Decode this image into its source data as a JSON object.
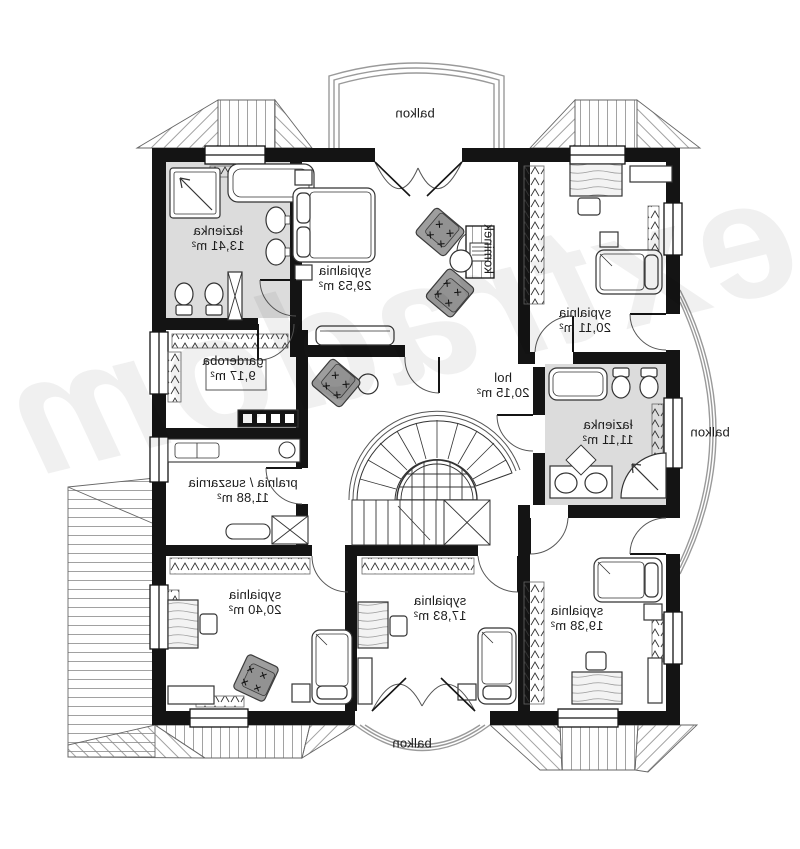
{
  "watermark": "extradom",
  "colors": {
    "wall": "#141414",
    "bath_floor": "#dcdcdc",
    "armchair": "#9e9e9e"
  },
  "labels": {
    "balcony": "balkon",
    "fireplace": "kominek"
  },
  "rooms": {
    "bath1": {
      "name": "łazienka",
      "area": "13,41 m²"
    },
    "master": {
      "name": "sypialnia",
      "area": "29,53 m²"
    },
    "bed2": {
      "name": "sypialnia",
      "area": "20,11 m²"
    },
    "wardrobe": {
      "name": "garderoba",
      "area": "9,17 m²"
    },
    "hall": {
      "name": "hol",
      "area": "20,15 m²"
    },
    "bath2": {
      "name": "łazienka",
      "area": "11,11 m²"
    },
    "laundry": {
      "name": "pralnia / suszarnia",
      "area": "11,88 m²"
    },
    "bed3": {
      "name": "sypialnia",
      "area": "20,40 m²"
    },
    "bed4": {
      "name": "sypialnia",
      "area": "17,83 m²"
    },
    "bed5": {
      "name": "sypialnia",
      "area": "19,38 m²"
    }
  }
}
